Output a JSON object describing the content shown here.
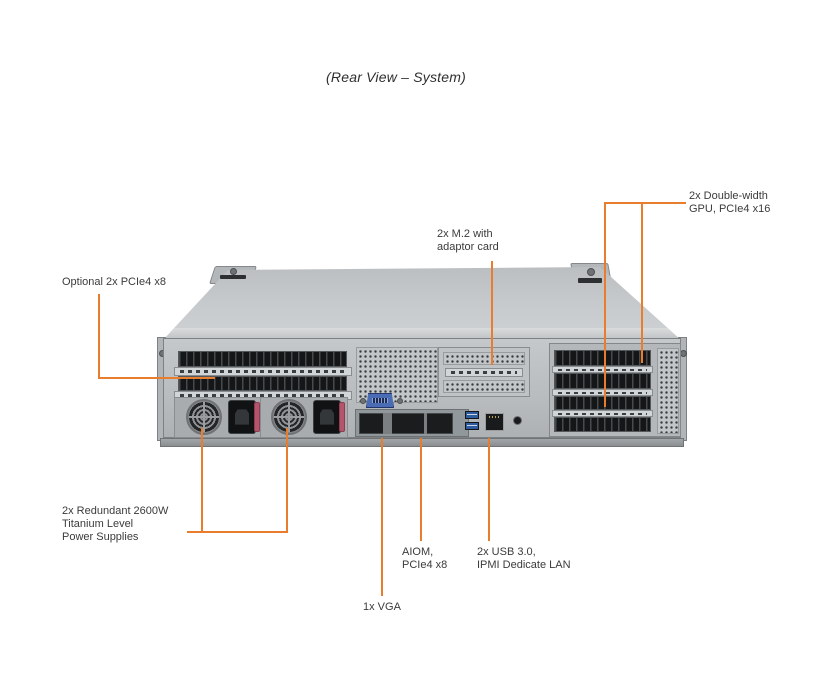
{
  "title": "(Rear View – System)",
  "colors": {
    "callout_line": "#E87E2D",
    "chassis": "#c5c8ca",
    "slot_dark": "#151617"
  },
  "callouts": {
    "optional_pcie": {
      "label": "Optional 2x PCIe4 x8"
    },
    "m2": {
      "line1": "2x M.2 with",
      "line2": "adaptor card"
    },
    "gpu": {
      "line1": "2x Double-width",
      "line2": "GPU, PCIe4 x16"
    },
    "psu": {
      "line1": "2x Redundant 2600W",
      "line2": "Titanium Level",
      "line3": "Power Supplies"
    },
    "aiom": {
      "line1": "AIOM,",
      "line2": "PCIe4 x8"
    },
    "usb_lan": {
      "line1": "2x USB 3.0,",
      "line2": "IPMI Dedicate LAN"
    },
    "vga": {
      "label": "1x VGA"
    }
  }
}
